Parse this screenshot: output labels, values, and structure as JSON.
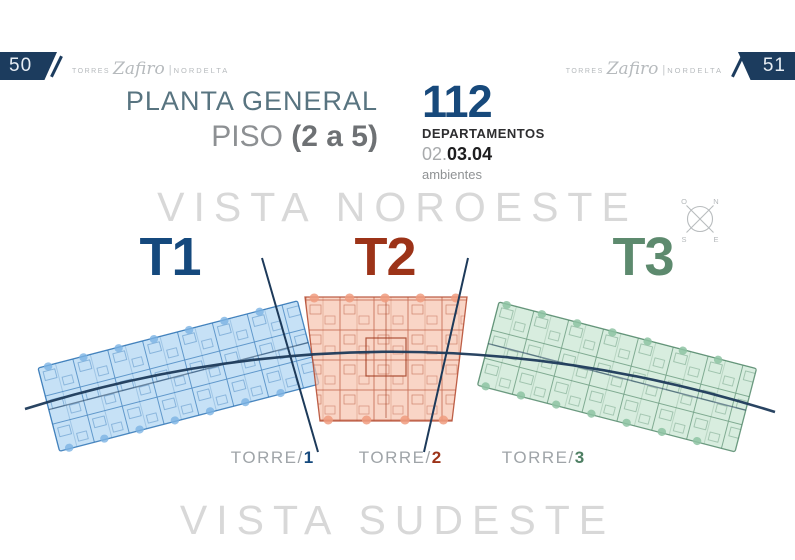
{
  "page": {
    "left_page_number": "50",
    "right_page_number": "51"
  },
  "brand": {
    "torres": "TORRES",
    "name": "Zafiro",
    "divider": "|",
    "location": "NORDELTA"
  },
  "title": {
    "line1": "PLANTA GENERAL",
    "line2_prefix": "PISO ",
    "line2_bold": "(2 a 5)"
  },
  "stats": {
    "count": "112",
    "label": "DEPARTAMENTOS",
    "rooms_prefix": "02.",
    "rooms_bold": "03.04",
    "rooms_suffix": "ambientes"
  },
  "views": {
    "top": "VISTA NOROESTE",
    "bottom": "VISTA SUDESTE"
  },
  "compass": {
    "n": "N",
    "o": "O",
    "s": "S",
    "e": "E"
  },
  "towers": [
    {
      "label": "T1",
      "torre_prefix": "TORRE/",
      "torre_number": "1",
      "accent": "#15497d",
      "fill": "#aed4f2",
      "line": "#2f74b5"
    },
    {
      "label": "T2",
      "torre_prefix": "TORRE/",
      "torre_number": "2",
      "accent": "#9c3318",
      "fill": "#f7c3ae",
      "line": "#b3472b"
    },
    {
      "label": "T3",
      "torre_prefix": "TORRE/",
      "torre_number": "3",
      "accent": "#5d8a6e",
      "fill": "#c9e6d3",
      "line": "#558a6c"
    }
  ],
  "colors": {
    "navy": "#1c3c5e",
    "corridor_line": "#1d3a5a",
    "header_gray": "#b6babd",
    "view_caption_gray": "#d8d8d8"
  }
}
